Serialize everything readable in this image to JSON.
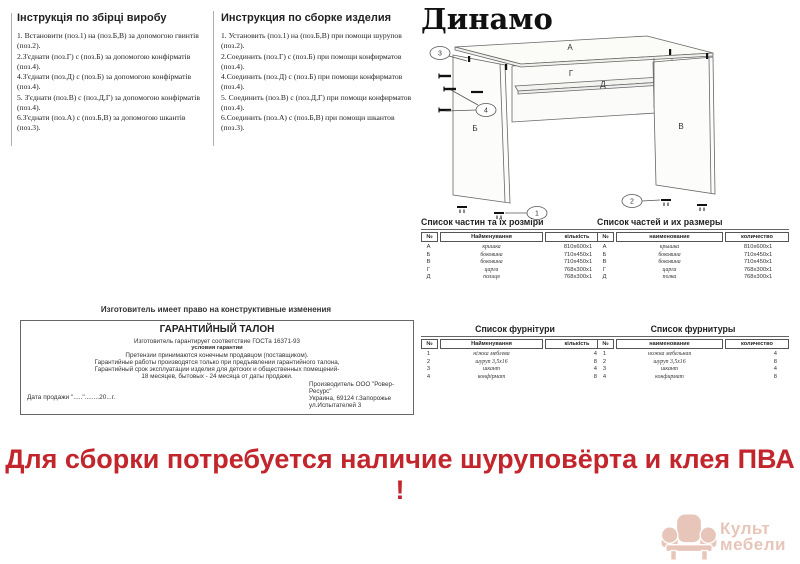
{
  "product": {
    "name": "Динамо"
  },
  "instructions_ua": {
    "title": "Інструкція по збірці виробу",
    "steps": [
      "1. Встановити (поз.1) на (поз.Б,В) за допомогою гвинтів (поз.2).",
      "2.З'єднати (поз.Г) с (поз.Б) за допомогою конфірматів (поз.4).",
      "4.З'єднати (поз.Д) с (поз.Б) за допомогою конфірматів (поз.4).",
      "5. З'єднати (поз.В) с (поз.Д,Г) за допомогою конфірматів (поз.4).",
      "6.З'єднати (поз.А) с (поз.Б,В) за допомогою шкантів (поз.3)."
    ]
  },
  "instructions_ru": {
    "title": "Инструкция по сборке изделия",
    "steps": [
      "1. Установить (поз.1) на (поз.Б,В) при помощи шурупов (поз.2).",
      "2.Соединить (поз.Г) с (поз.Б) при помощи конфирматов (поз.4).",
      "4.Соединить (поз.Д) с (поз.Б) при помощи конфирматов (поз.4).",
      "5. Соединить (поз.В) с (поз.Д,Г) при помощи конфирматов (поз.4).",
      "6.Соединить (поз.А) с (поз.Б,В) при помощи шкантов (поз.3)."
    ]
  },
  "diagram": {
    "label_a": "А",
    "label_b": "Б",
    "label_v": "В",
    "label_g": "Г",
    "label_d": "Д",
    "callout_1": "1",
    "callout_2": "2",
    "callout_3": "3",
    "callout_4": "4"
  },
  "parts_ua": {
    "title": "Список частин та їх розміри",
    "columns": [
      "№",
      "Найменування",
      "кількість"
    ],
    "rows": [
      [
        "А",
        "кришка",
        "810х600х1"
      ],
      [
        "Б",
        "боковина",
        "710х450х1"
      ],
      [
        "В",
        "боковина",
        "710х450х1"
      ],
      [
        "Г",
        "царга",
        "768х300х1"
      ],
      [
        "Д",
        "полиця",
        "768х300х1"
      ]
    ]
  },
  "parts_ru": {
    "title": "Список частей и их размеры",
    "columns": [
      "№",
      "наименование",
      "количество"
    ],
    "rows": [
      [
        "А",
        "крышка",
        "810х600х1"
      ],
      [
        "Б",
        "боковина",
        "710х450х1"
      ],
      [
        "В",
        "боковина",
        "710х450х1"
      ],
      [
        "Г",
        "царга",
        "768х300х1"
      ],
      [
        "Д",
        "полка",
        "768х300х1"
      ]
    ]
  },
  "hardware_ua": {
    "title": "Список фурнітури",
    "columns": [
      "№",
      "Найменування",
      "кількість"
    ],
    "rows": [
      [
        "1",
        "ніжка меблева",
        "4"
      ],
      [
        "2",
        "шуруп 3,5х16",
        "8"
      ],
      [
        "3",
        "шкант",
        "4"
      ],
      [
        "4",
        "конфірмат",
        "8"
      ]
    ]
  },
  "hardware_ru": {
    "title": "Список фурнитуры",
    "columns": [
      "№",
      "наименование",
      "количество"
    ],
    "rows": [
      [
        "1",
        "ножка мебельная",
        "4"
      ],
      [
        "2",
        "шуруп 3,5х16",
        "8"
      ],
      [
        "3",
        "шкант",
        "4"
      ],
      [
        "4",
        "конфирмат",
        "8"
      ]
    ]
  },
  "warranty": {
    "notice": "Изготовитель имеет право на конструктивные изменения",
    "title": "ГАРАНТИЙНЫЙ ТАЛОН",
    "line1": "Изготовитель гарантирует соответствие ГОСТа 16371-93",
    "line2": "условия гарантии",
    "line3": "Претензии принимаются конечным продавцом (поставщиком).",
    "line4": "Гарантийные работы производятся только при предъявлении гарантийного талона,",
    "line5": "Гарантийный срок эксплуатации изделия для детских и общественных помещений-",
    "line6": "18 месяцев, бытовых - 24 месяца от даты продажи.",
    "date_label": "Дата продажи \".....\"........20...г.",
    "producer1": "Производитель ООО \"Ровер-Ресурс\"",
    "producer2": "Украина, 69124 г.Запорожье",
    "producer3": "ул.Испытателей 3"
  },
  "footer": {
    "warning": "Для сборки потребуется наличие шуруповёрта и клея ПВА !",
    "warning_color": "#c2262c"
  },
  "logo": {
    "line1": "Культ",
    "line2": "мебели",
    "color": "#e8c5b9"
  }
}
